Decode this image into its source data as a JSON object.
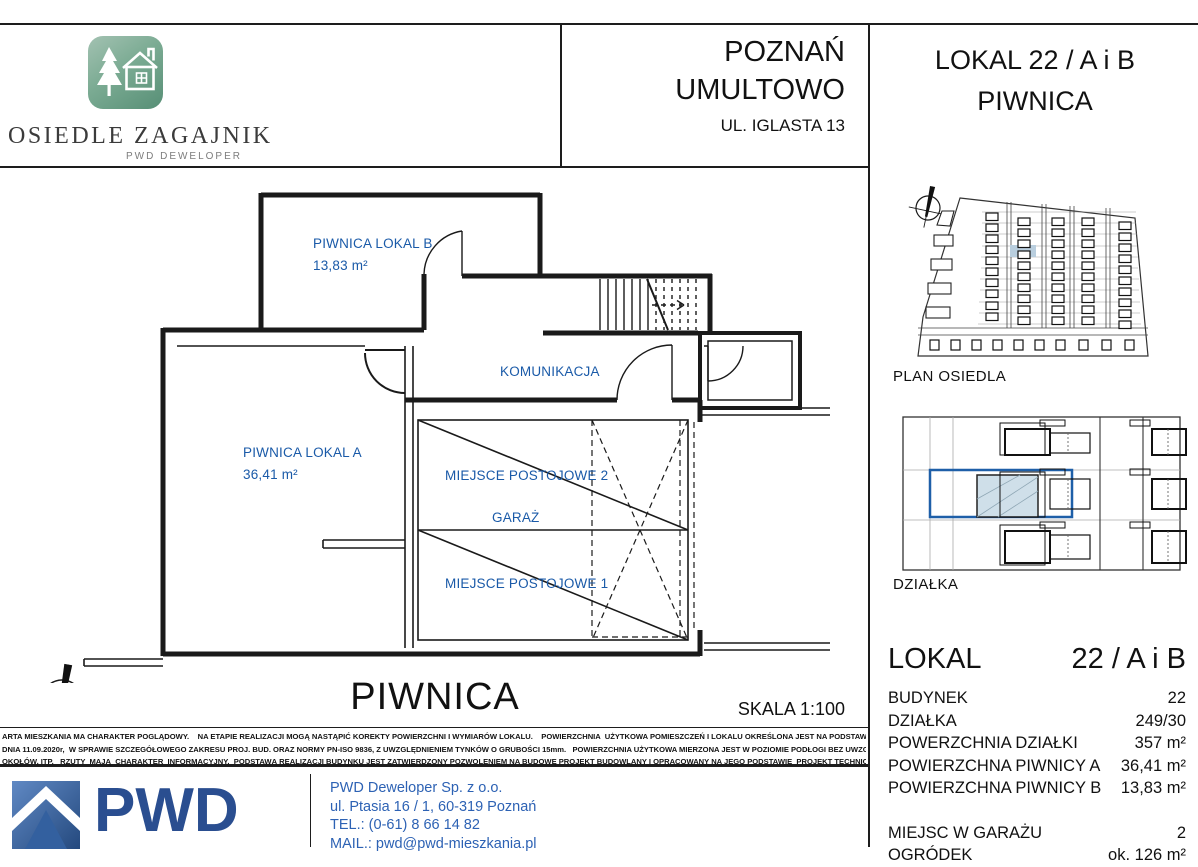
{
  "header": {
    "project_name": "OSIEDLE ZAGAJNIK",
    "project_subtitle": "PWD DEWELOPER",
    "city": "POZNAŃ",
    "district": "UMULTOWO",
    "street": "UL. IGLASTA 13",
    "unit_title": "LOKAL 22 / A i B",
    "unit_subtitle": "PIWNICA"
  },
  "plan": {
    "rooms": {
      "piwnica_b_name": "PIWNICA LOKAL B",
      "piwnica_b_area": "13,83  m²",
      "komunikacja": "KOMUNIKACJA",
      "piwnica_a_name": "PIWNICA LOKAL A",
      "piwnica_a_area": "36,41 m²",
      "parking2": "MIEJSCE POSTOJOWE 2",
      "garaz": "GARAŻ",
      "parking1": "MIEJSCE POSTOJOWE 1"
    },
    "title": "PIWNICA",
    "scale_label": "SKALA  1:100"
  },
  "sidebar": {
    "site_plan_label": "PLAN OSIEDLA",
    "plot_label": "DZIAŁKA",
    "lokal_heading": "LOKAL",
    "lokal_value": "22 / A i B",
    "details": [
      {
        "label": "BUDYNEK",
        "value": "22"
      },
      {
        "label": "DZIAŁKA",
        "value": "249/30"
      },
      {
        "label": "POWERZCHNIA DZIAŁKI",
        "value": "357 m²"
      },
      {
        "label": "POWIERZCHNA PIWNICY A",
        "value": "36,41 m²"
      },
      {
        "label": "POWIERZCHNA PIWNICY B",
        "value": "13,83 m²"
      }
    ],
    "details2": [
      {
        "label": "MIEJSC W GARAŻU",
        "value": "2"
      },
      {
        "label": "OGRÓDEK",
        "value": "ok. 126 m²"
      }
    ]
  },
  "disclaimer": {
    "line1": "ARTA MIESZKANIA MA CHARAKTER POGLĄDOWY.    NA ETAPIE REALIZACJI MOGĄ NASTĄPIĆ KOREKTY POWIERZCHNI I WYMIARÓW LOKALU.    POWIERZCHNIA  UŻYTKOWA POMIESZCZEŃ I LOKALU OKREŚLONA JEST NA PODSTAWIE ROZP. MIN. ROZW.",
    "line2": "DNIA 11.09.2020r,  W SPRAWIE SZCZEGÓŁOWEGO ZAKRESU PROJ. BUD. ORAZ NORMY PN-ISO 9836, Z UWZGLĘDNIENIEM TYNKÓW O GRUBOŚCI 15mm.   POWIERZCHNIA UŻYTKOWA MIERZONA JEST W POZIOMIE PODŁOGI BEZ UWZGLĘDNIENIA LISTEW,",
    "line3": "OKOŁÓW, ITP.   RZUTY  MAJĄ  CHARAKTER  INFORMACYJNY.  PODSTAWĄ REALIZACJI BUDYNKU JEST ZATWIERDZONY POZWOLENIEM NA BUDOWĘ PROJEKT BUDOWLANY I OPRACOWANY NA JEGO PODSTAWIE  PROJEKT TECHNICZNY I WYKONAWCZY."
  },
  "footer": {
    "logo_text": "PWD",
    "company": "PWD Deweloper Sp. z o.o.",
    "address": "ul. Ptasia 16 / 1, 60-319 Poznań",
    "phone": "TEL.:  (0-61) 8 66 14 82",
    "email": "MAIL.: pwd@pwd-mieszkania.pl"
  },
  "colors": {
    "room_label_blue": "#1a5aa8",
    "highlight_fill": "#b9cede",
    "highlight_outline": "#1e5fa8",
    "pwd_blue": "#2a4e90",
    "logo_green": "#578f76"
  }
}
